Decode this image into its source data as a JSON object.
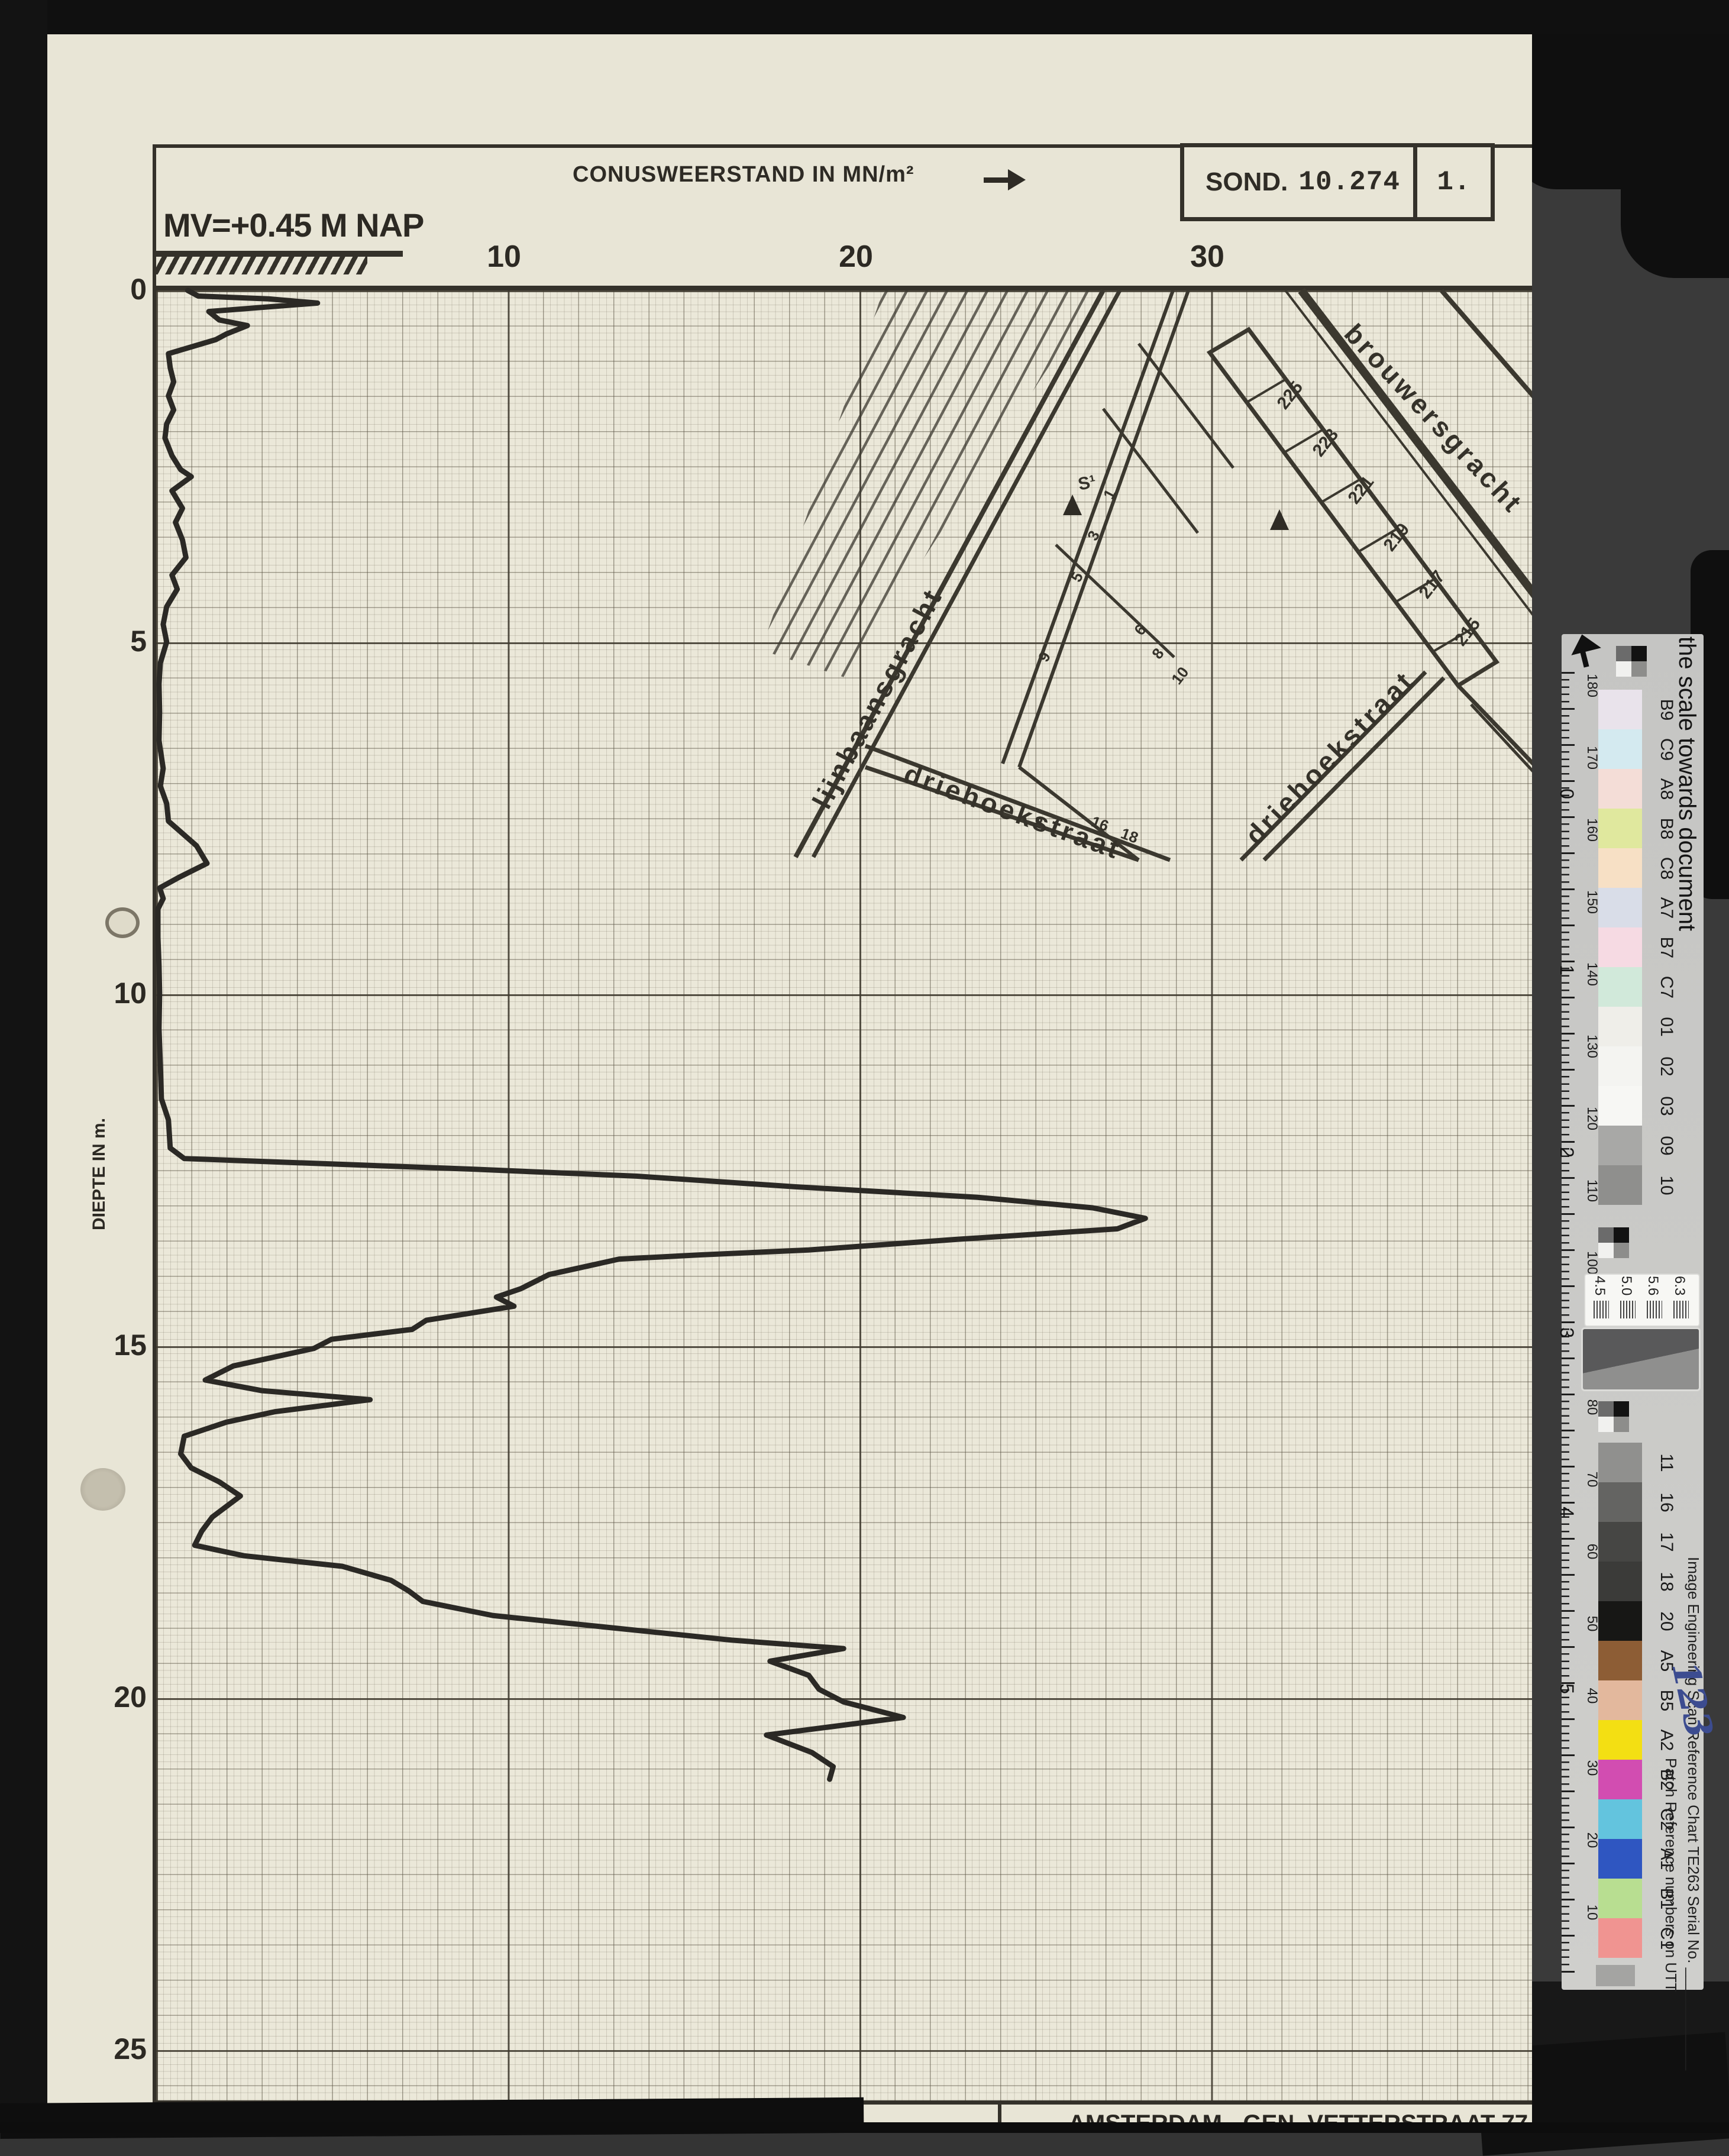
{
  "header": {
    "axis_title": "CONUSWEERSTAND IN MN/m²",
    "arrow": "→",
    "sond_label": "SOND.",
    "sond_number": "10.274",
    "sheet_number": "1.",
    "mv_label": "MV=+0.45 M NAP"
  },
  "axes": {
    "x_ticks": [
      "10",
      "20",
      "30"
    ],
    "y_ticks": [
      "0",
      "5",
      "10",
      "15",
      "20",
      "25"
    ],
    "y_axis_label": "DIEPTE IN m."
  },
  "map": {
    "streets": [
      "lijnbaansgracht",
      "brouwersgracht",
      "driehoekstraat",
      "driehoekstraat"
    ],
    "house_numbers": [
      "225",
      "223",
      "221",
      "219",
      "217",
      "215"
    ],
    "small_numbers": [
      "1",
      "3",
      "5",
      "9",
      "6",
      "8",
      "10",
      "16",
      "18",
      "2"
    ],
    "marker_label": "S¹"
  },
  "footer": {
    "company": "de waal ingenieursbureau b.v.",
    "address": "AMSTERDAM - GEN. VETTERSTRAAT 77",
    "phone": "TELEFOON 020 - 174844",
    "telex": "TELEX 14510"
  },
  "scan": {
    "strip": {
      "title": "the scale towards document",
      "footer_utt": "Patch Reference numbers on UTT",
      "footer_serial": "Image Engineering    Scan Reference Chart   TE263    Serial No. ____________",
      "serial_handwritten": "123",
      "cm_labels": [
        "0",
        "1",
        "2",
        "3",
        "4",
        "5"
      ],
      "mm_labels": [
        "180",
        "170",
        "160",
        "150",
        "140",
        "130",
        "120",
        "110",
        "100",
        "90",
        "80",
        "70",
        "60",
        "50",
        "40",
        "30",
        "20",
        "10"
      ],
      "res_numbers": [
        "4.5",
        "5.0",
        "5.6",
        "6.3"
      ],
      "items": [
        {
          "label": "B9",
          "color": "#e9e3eb",
          "h": 67
        },
        {
          "label": "C9",
          "color": "#d4eaf0",
          "h": 67
        },
        {
          "label": "A8",
          "color": "#f4ddd7",
          "h": 67
        },
        {
          "label": "B8",
          "color": "#e0e89e",
          "h": 67
        },
        {
          "label": "C8",
          "color": "#f7e0c5",
          "h": 67
        },
        {
          "label": "A7",
          "color": "#d9dde8",
          "h": 67
        },
        {
          "label": "B7",
          "color": "#f6dae3",
          "h": 67
        },
        {
          "label": "C7",
          "color": "#d1e9da",
          "h": 67
        },
        {
          "label": "01",
          "color": "#efeee9",
          "h": 67
        },
        {
          "label": "02",
          "color": "#f4f4f1",
          "h": 67
        },
        {
          "label": "03",
          "color": "#f7f7f4",
          "h": 67
        },
        {
          "label": "09",
          "color": "#a8a8a6",
          "h": 67
        },
        {
          "label": "10",
          "color": "#8f8f8d",
          "h": 67
        },
        {
          "type": "gap",
          "h": 38
        },
        {
          "type": "checker",
          "h": 52
        },
        {
          "type": "gap",
          "h": 28
        },
        {
          "type": "rescard",
          "h": 86
        },
        {
          "type": "gap",
          "h": 6
        },
        {
          "type": "graycard",
          "h": 102
        },
        {
          "type": "gap",
          "h": 20
        },
        {
          "type": "checker",
          "h": 52
        },
        {
          "type": "gap",
          "h": 18
        },
        {
          "label": "11",
          "color": "#90908e",
          "h": 67
        },
        {
          "label": "16",
          "color": "#646462",
          "h": 67
        },
        {
          "label": "17",
          "color": "#464644",
          "h": 67
        },
        {
          "label": "18",
          "color": "#3b3b39",
          "h": 67
        },
        {
          "label": "20",
          "color": "#171715",
          "h": 67
        },
        {
          "label": "A5",
          "color": "#8d5d35",
          "h": 67
        },
        {
          "label": "B5",
          "color": "#e3b89d",
          "h": 67
        },
        {
          "label": "A2",
          "color": "#f3df13",
          "h": 67
        },
        {
          "label": "B2",
          "color": "#d24db1",
          "h": 67
        },
        {
          "label": "C2",
          "color": "#63c4de",
          "h": 67
        },
        {
          "label": "A1",
          "color": "#2f56c1",
          "h": 67
        },
        {
          "label": "B1",
          "color": "#b8de91",
          "h": 67
        },
        {
          "label": "C1",
          "color": "#f09491",
          "h": 67
        },
        {
          "type": "gap",
          "h": 12
        },
        {
          "type": "smudge",
          "h": 36
        }
      ]
    }
  },
  "chart_data": {
    "type": "line",
    "title": "Sondering (CPT) SOND. 10.274",
    "xlabel": "CONUSWEERSTAND IN MN/m²",
    "ylabel": "DIEPTE IN m.",
    "xlim": [
      0,
      40
    ],
    "ylim": [
      0,
      25.8
    ],
    "x_ticks": [
      10,
      20,
      30
    ],
    "y_ticks": [
      0,
      5,
      10,
      15,
      20,
      25
    ],
    "grid": "graph-paper, fine 0.2 units / 0.1 m, major every 10 units / 5 m",
    "legend_position": "none",
    "series": [
      {
        "name": "conusweerstand",
        "units_x": "MN/m²",
        "units_y": "m depth below MV (+0.45 m NAP)",
        "points": [
          [
            0,
            0.9
          ],
          [
            0.08,
            1.2
          ],
          [
            0.12,
            3.2
          ],
          [
            0.18,
            4.6
          ],
          [
            0.3,
            1.5
          ],
          [
            0.42,
            1.8
          ],
          [
            0.5,
            2.6
          ],
          [
            0.62,
            2.0
          ],
          [
            0.7,
            1.7
          ],
          [
            0.9,
            0.35
          ],
          [
            1.1,
            0.4
          ],
          [
            1.3,
            0.5
          ],
          [
            1.5,
            0.35
          ],
          [
            1.7,
            0.5
          ],
          [
            1.9,
            0.3
          ],
          [
            2.1,
            0.25
          ],
          [
            2.35,
            0.45
          ],
          [
            2.55,
            0.7
          ],
          [
            2.65,
            1.0
          ],
          [
            2.85,
            0.45
          ],
          [
            3.1,
            0.75
          ],
          [
            3.3,
            0.55
          ],
          [
            3.55,
            0.75
          ],
          [
            3.8,
            0.85
          ],
          [
            4.05,
            0.45
          ],
          [
            4.25,
            0.6
          ],
          [
            4.5,
            0.3
          ],
          [
            4.75,
            0.2
          ],
          [
            5.0,
            0.3
          ],
          [
            5.3,
            0.12
          ],
          [
            5.6,
            0.08
          ],
          [
            6.0,
            0.1
          ],
          [
            6.4,
            0.08
          ],
          [
            6.8,
            0.2
          ],
          [
            7.05,
            0.12
          ],
          [
            7.3,
            0.3
          ],
          [
            7.55,
            0.35
          ],
          [
            7.9,
            1.15
          ],
          [
            8.15,
            1.45
          ],
          [
            8.35,
            0.65
          ],
          [
            8.5,
            0.1
          ],
          [
            8.65,
            0.2
          ],
          [
            8.8,
            0.05
          ],
          [
            9.2,
            0.05
          ],
          [
            9.6,
            0.08
          ],
          [
            10.0,
            0.1
          ],
          [
            10.5,
            0.08
          ],
          [
            11.0,
            0.12
          ],
          [
            11.5,
            0.15
          ],
          [
            11.8,
            0.35
          ],
          [
            12.2,
            0.4
          ],
          [
            12.35,
            0.8
          ],
          [
            12.5,
            9.0
          ],
          [
            12.6,
            13.7
          ],
          [
            12.75,
            18.2
          ],
          [
            12.9,
            23.4
          ],
          [
            13.05,
            26.7
          ],
          [
            13.2,
            28.2
          ],
          [
            13.35,
            27.4
          ],
          [
            13.5,
            22.8
          ],
          [
            13.65,
            18.6
          ],
          [
            13.72,
            15.5
          ],
          [
            13.78,
            13.2
          ],
          [
            14.0,
            11.2
          ],
          [
            14.2,
            10.4
          ],
          [
            14.32,
            9.7
          ],
          [
            14.45,
            10.2
          ],
          [
            14.65,
            7.7
          ],
          [
            14.78,
            7.3
          ],
          [
            14.92,
            5.0
          ],
          [
            15.05,
            4.5
          ],
          [
            15.3,
            2.2
          ],
          [
            15.5,
            1.4
          ],
          [
            15.65,
            3.0
          ],
          [
            15.78,
            6.1
          ],
          [
            15.95,
            3.4
          ],
          [
            16.1,
            2.0
          ],
          [
            16.3,
            0.8
          ],
          [
            16.55,
            0.7
          ],
          [
            16.75,
            1.0
          ],
          [
            16.95,
            1.8
          ],
          [
            17.15,
            2.4
          ],
          [
            17.45,
            1.6
          ],
          [
            17.65,
            1.3
          ],
          [
            17.85,
            1.1
          ],
          [
            18.0,
            2.5
          ],
          [
            18.15,
            5.3
          ],
          [
            18.35,
            6.7
          ],
          [
            18.5,
            7.2
          ],
          [
            18.65,
            7.6
          ],
          [
            18.85,
            9.6
          ],
          [
            19.05,
            13.5
          ],
          [
            19.2,
            16.4
          ],
          [
            19.32,
            19.6
          ],
          [
            19.5,
            17.5
          ],
          [
            19.7,
            18.6
          ],
          [
            19.9,
            18.9
          ],
          [
            20.08,
            19.6
          ],
          [
            20.3,
            21.3
          ],
          [
            20.55,
            17.4
          ],
          [
            20.8,
            18.7
          ],
          [
            21.0,
            19.3
          ],
          [
            21.18,
            19.2
          ]
        ]
      }
    ]
  }
}
